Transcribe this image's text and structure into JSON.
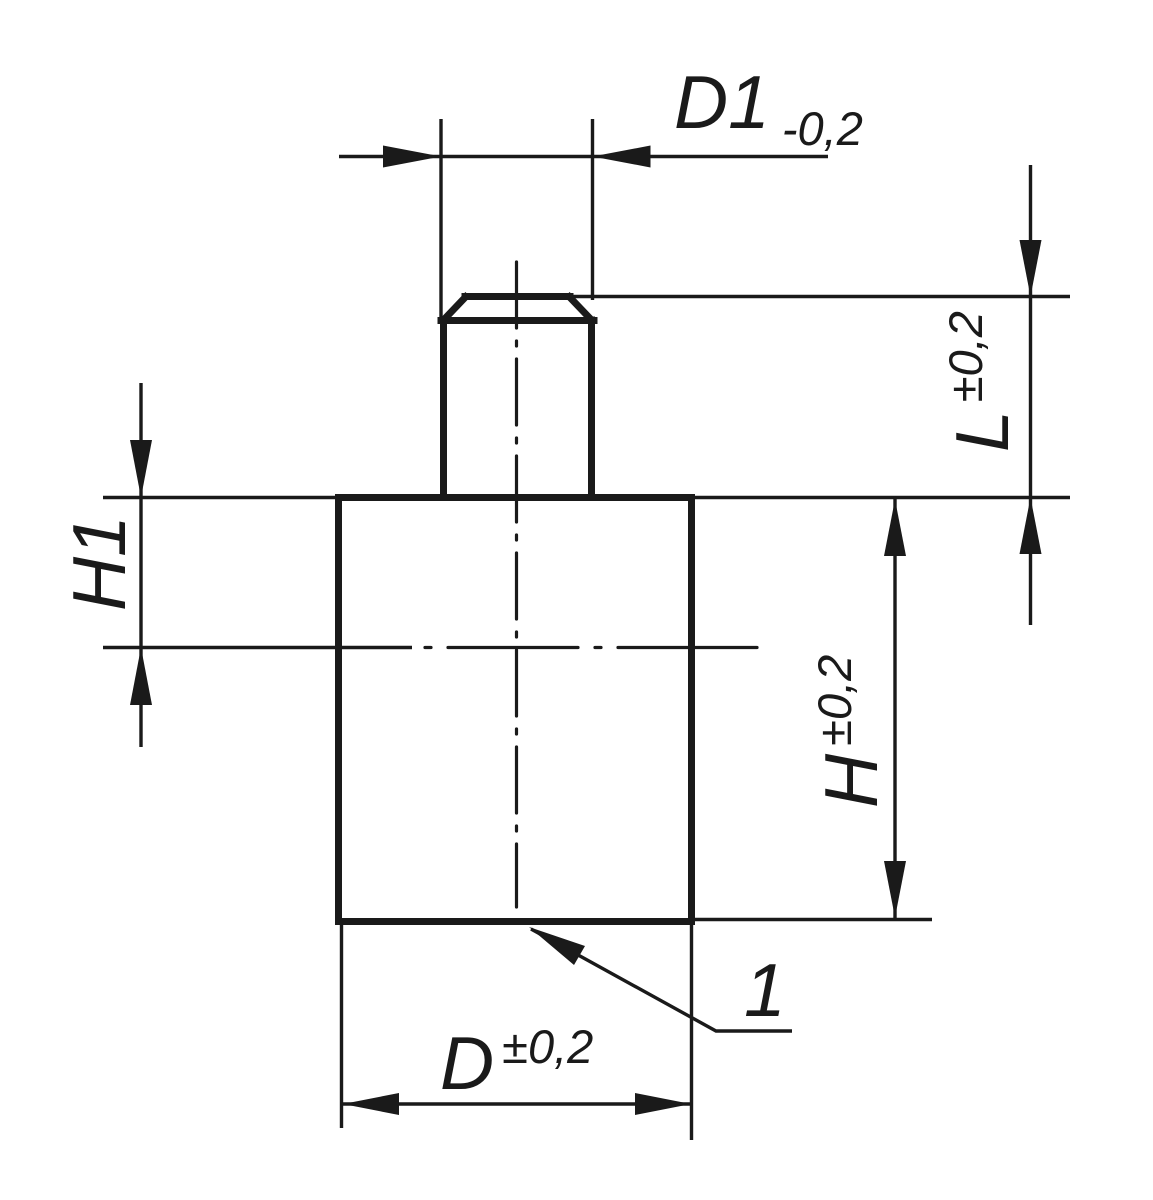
{
  "drawing": {
    "type": "technical-dimension-drawing",
    "background_color": "#ffffff",
    "line_color": "#1a1a1a",
    "dimensions": {
      "d1": {
        "name": "D1",
        "tolerance": "-0,2"
      },
      "l": {
        "name": "L",
        "tolerance": "±0,2"
      },
      "h1": {
        "name": "H1"
      },
      "h": {
        "name": "H",
        "tolerance": "±0,2"
      },
      "d": {
        "name": "D",
        "tolerance": "±0,2"
      }
    },
    "callout": {
      "label": "1"
    }
  }
}
